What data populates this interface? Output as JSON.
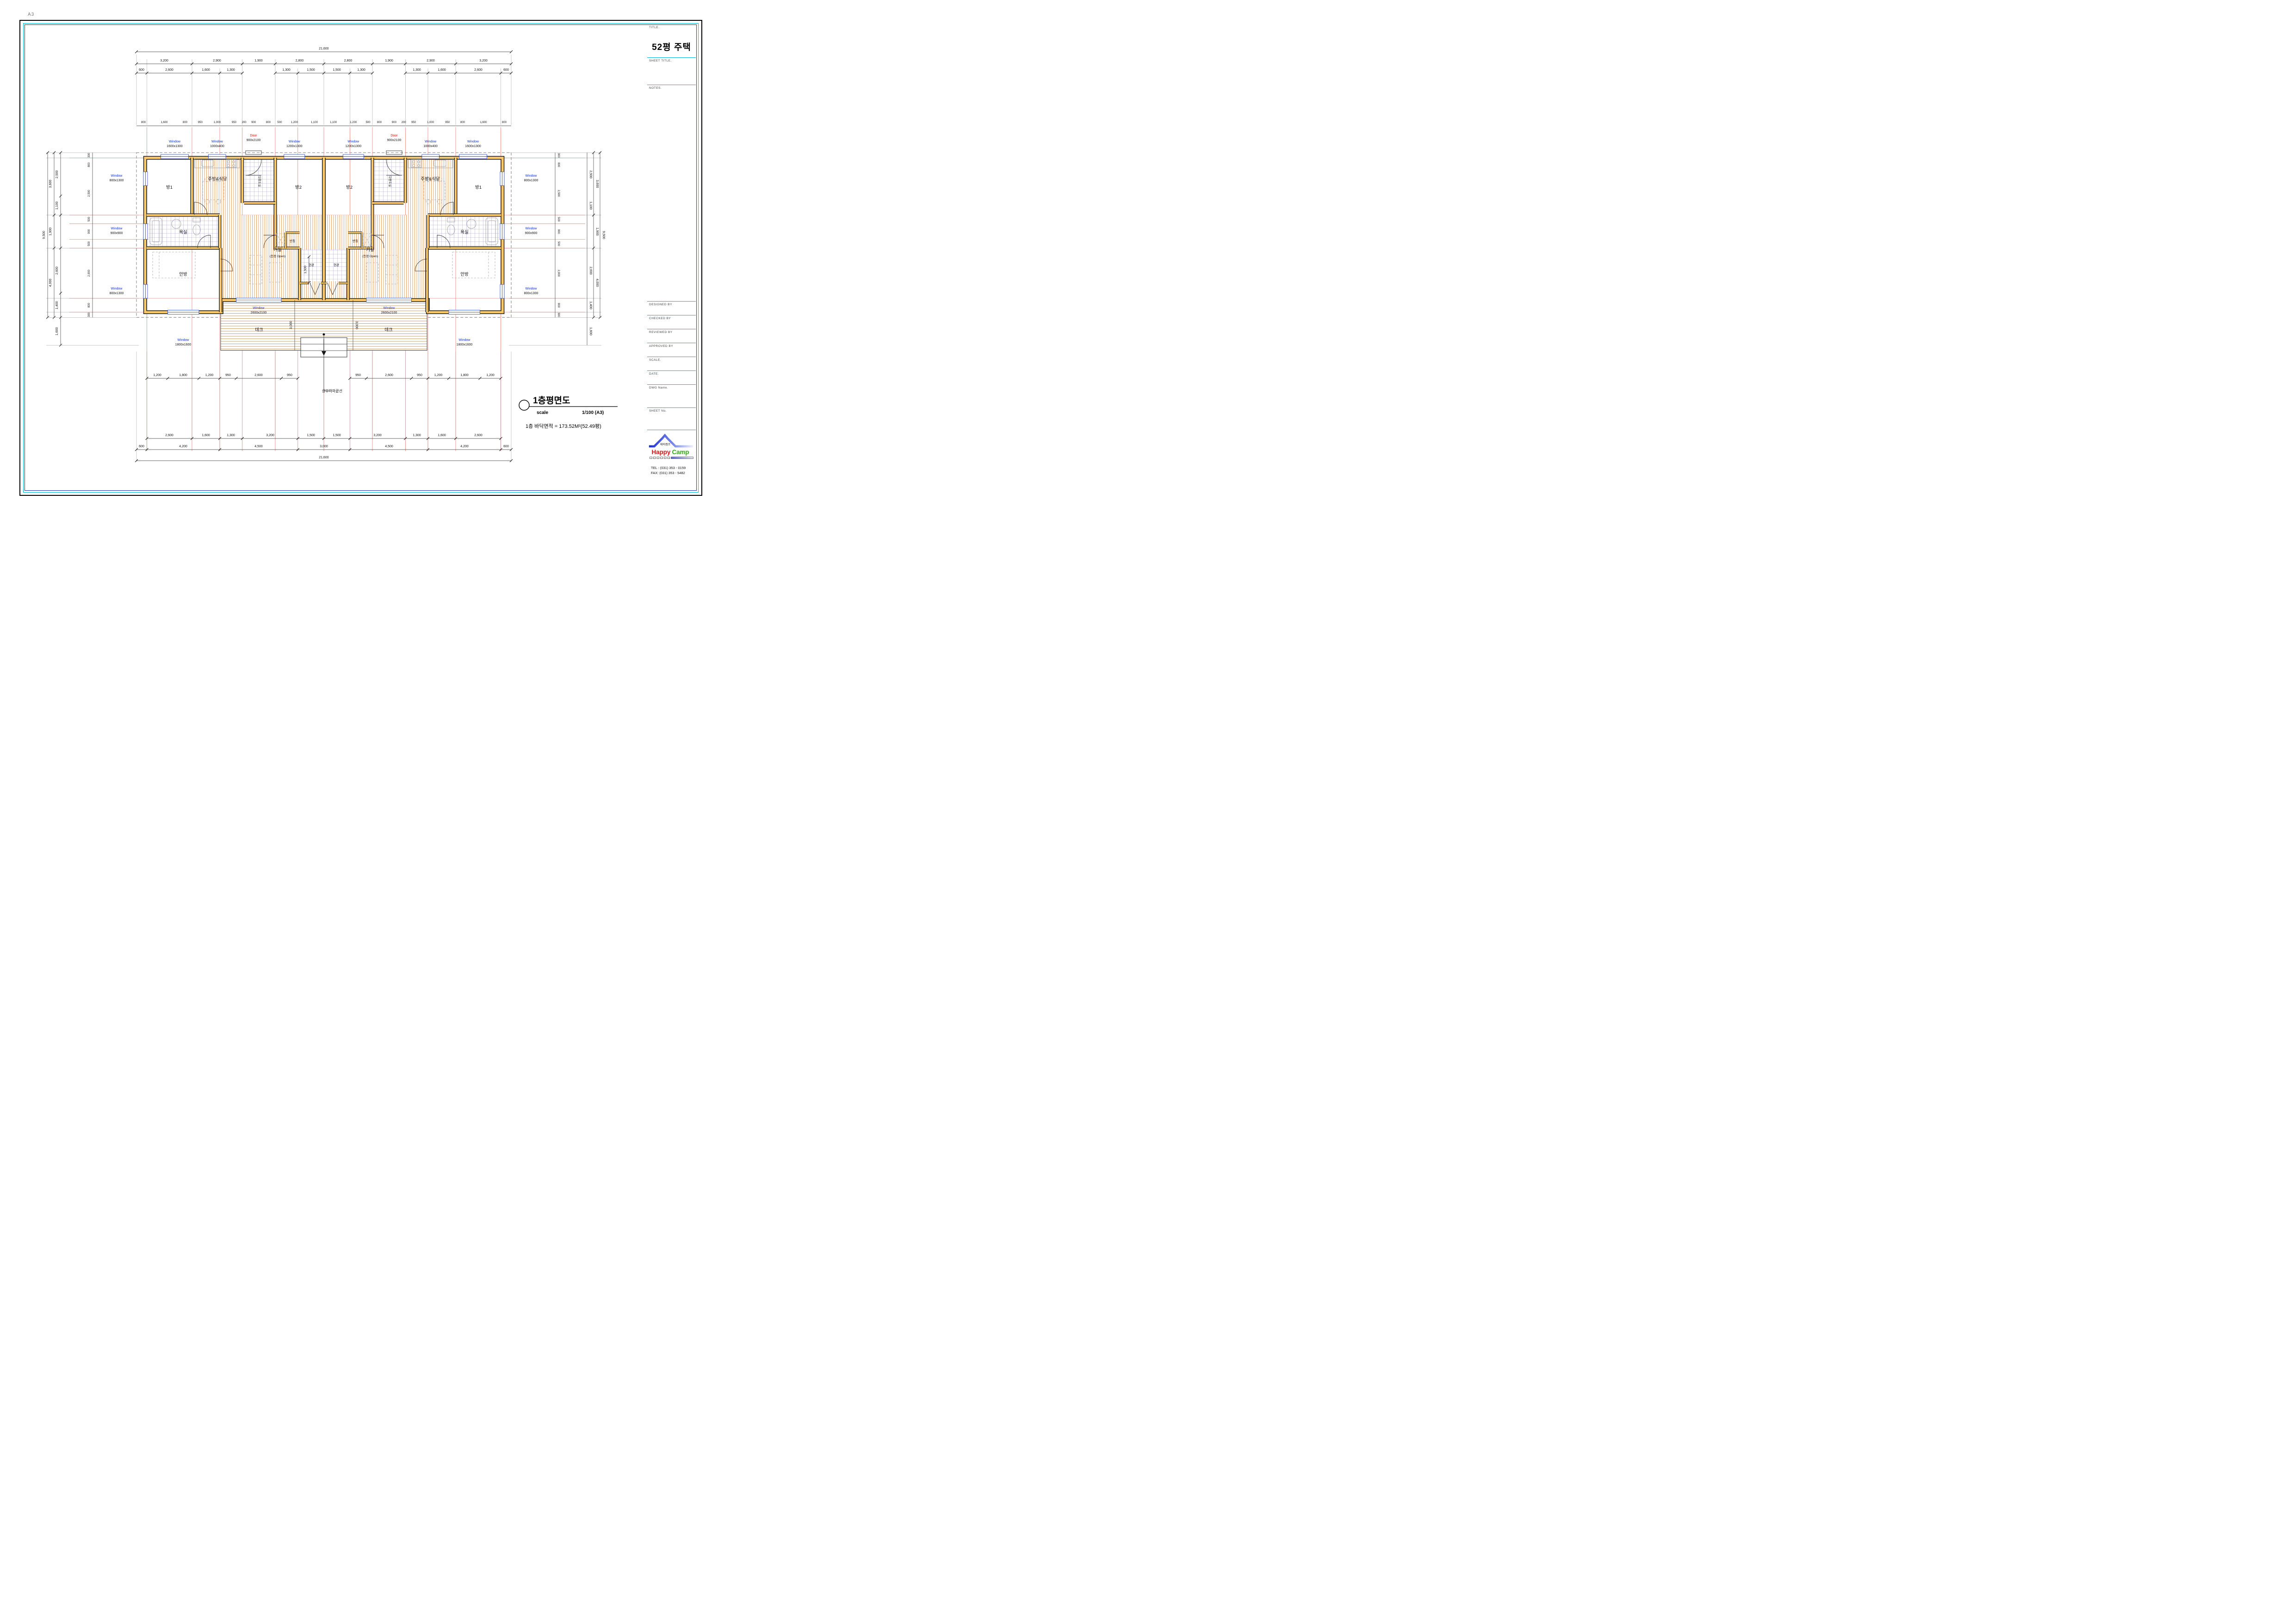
{
  "sheet": {
    "size": "A3"
  },
  "title_block": {
    "title_label": "TITLE.",
    "title": "52평 주택",
    "sheet_title_label": "SHEET TITLE.",
    "notes_label": "NOTES.",
    "rows": [
      "DESIGNED  BY",
      "CHECKED  BY",
      "REVIEWED  BY",
      "APPROVED  BY",
      "SCALE.",
      "DATE.",
      "DWG  Name.",
      "SHEET  No."
    ],
    "logo": {
      "kr": "해피캠프",
      "w1": "Happy",
      "w2": "Camp"
    },
    "tel": "TEL : (031) 353 - 0159",
    "fax": "FAX: (031) 353 - 5482"
  },
  "drawing_title": {
    "name": "1층평면도",
    "scale_label": "scale",
    "scale": "1/100 (A3)",
    "area": "1층 바닥면적 = 173.52M²(52.49평)"
  },
  "rooms": {
    "bang1": "방1",
    "bang2": "방2",
    "kitchen": "주방&식당",
    "utility": "다용도실",
    "closet": "반침",
    "bath": "욕실",
    "living": "거실",
    "living_note": "(천정 Open)",
    "master": "안방",
    "entry": "현관",
    "deck": "데크"
  },
  "windows": {
    "win": "Window",
    "door": "Door",
    "top": [
      "1600x1300",
      "1000x400",
      "900x2100",
      "1200x1300"
    ],
    "side": [
      "800x1300",
      "900x900",
      "800x1300"
    ],
    "living": "2600x2100",
    "master": "1800x1600"
  },
  "annotations": {
    "eaves": "상부처마끝선",
    "porch": "1,500",
    "deck_depth": "3,000"
  },
  "dims": {
    "top_total": "21,600",
    "top2": [
      "3,200",
      "2,900",
      "1,900",
      "2,800",
      "2,800",
      "1,900",
      "2,900",
      "3,200"
    ],
    "top3": [
      "600",
      "2,600",
      "1,600",
      "1,300",
      "1,300",
      "1,500",
      "1,500",
      "1,300",
      "1,300",
      "1,600",
      "2,600",
      "600"
    ],
    "top4": [
      "800",
      "1,600",
      "800",
      "950",
      "1,000",
      "950",
      "200",
      "900",
      "800",
      "500",
      "1,200",
      "1,100",
      "1,100",
      "1,200",
      "500",
      "800",
      "900",
      "200",
      "950",
      "1,000",
      "950",
      "800",
      "1,600",
      "800"
    ],
    "deck_row": [
      "1,200",
      "1,800",
      "1,200",
      "950",
      "2,600",
      "950",
      "950",
      "2,600",
      "950",
      "1,200",
      "1,800",
      "1,200"
    ],
    "bot1": [
      "2,600",
      "1,600",
      "1,300",
      "3,200",
      "1,500",
      "1,500",
      "3,200",
      "1,300",
      "1,600",
      "2,600"
    ],
    "bot2": [
      "600",
      "4,200",
      "4,500",
      "3,000",
      "4,500",
      "4,200",
      "600"
    ],
    "bot_total": "21,600",
    "v_outer": "9,500",
    "v_mid": [
      "3,600",
      "1,900",
      "4,000"
    ],
    "v_inner": [
      "2,500",
      "1,100",
      "2,600",
      "1,400",
      "1,600"
    ],
    "v_wall": [
      "300",
      "800",
      "2,500",
      "500",
      "900",
      "500",
      "2,900",
      "800",
      "300"
    ]
  }
}
